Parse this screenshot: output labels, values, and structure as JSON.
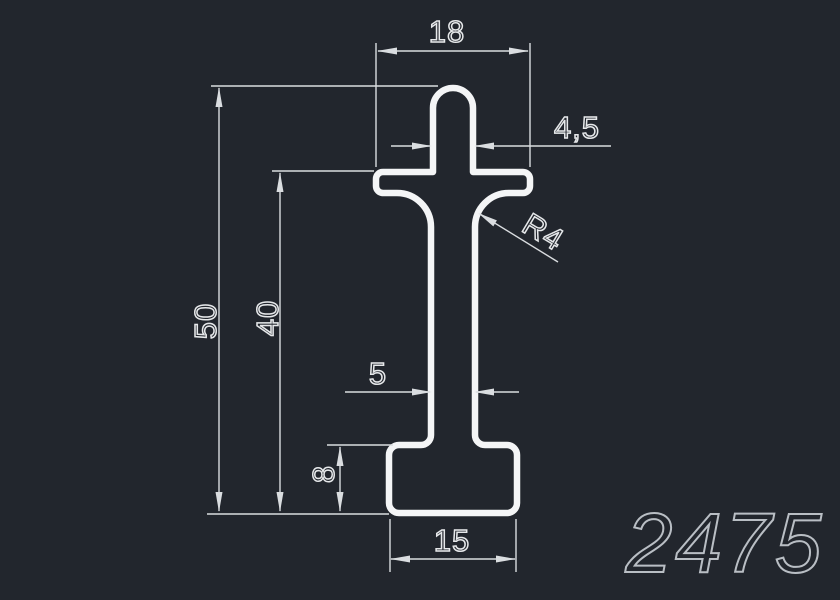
{
  "part_number": "2475",
  "dimensions": {
    "top_width": {
      "label": "18"
    },
    "stem_width": {
      "label": "4,5"
    },
    "fillet_radius": {
      "label": "R4"
    },
    "total_height": {
      "label": "50"
    },
    "body_height": {
      "label": "40"
    },
    "web_thickness": {
      "label": "5"
    },
    "base_height": {
      "label": "8"
    },
    "base_width": {
      "label": "15"
    }
  },
  "colors": {
    "background": "#22262d",
    "outline": "#f4f5f6",
    "dim": "#dadde0",
    "dimtext": "#e6e8ea",
    "partnumber": "#b9bec4"
  }
}
